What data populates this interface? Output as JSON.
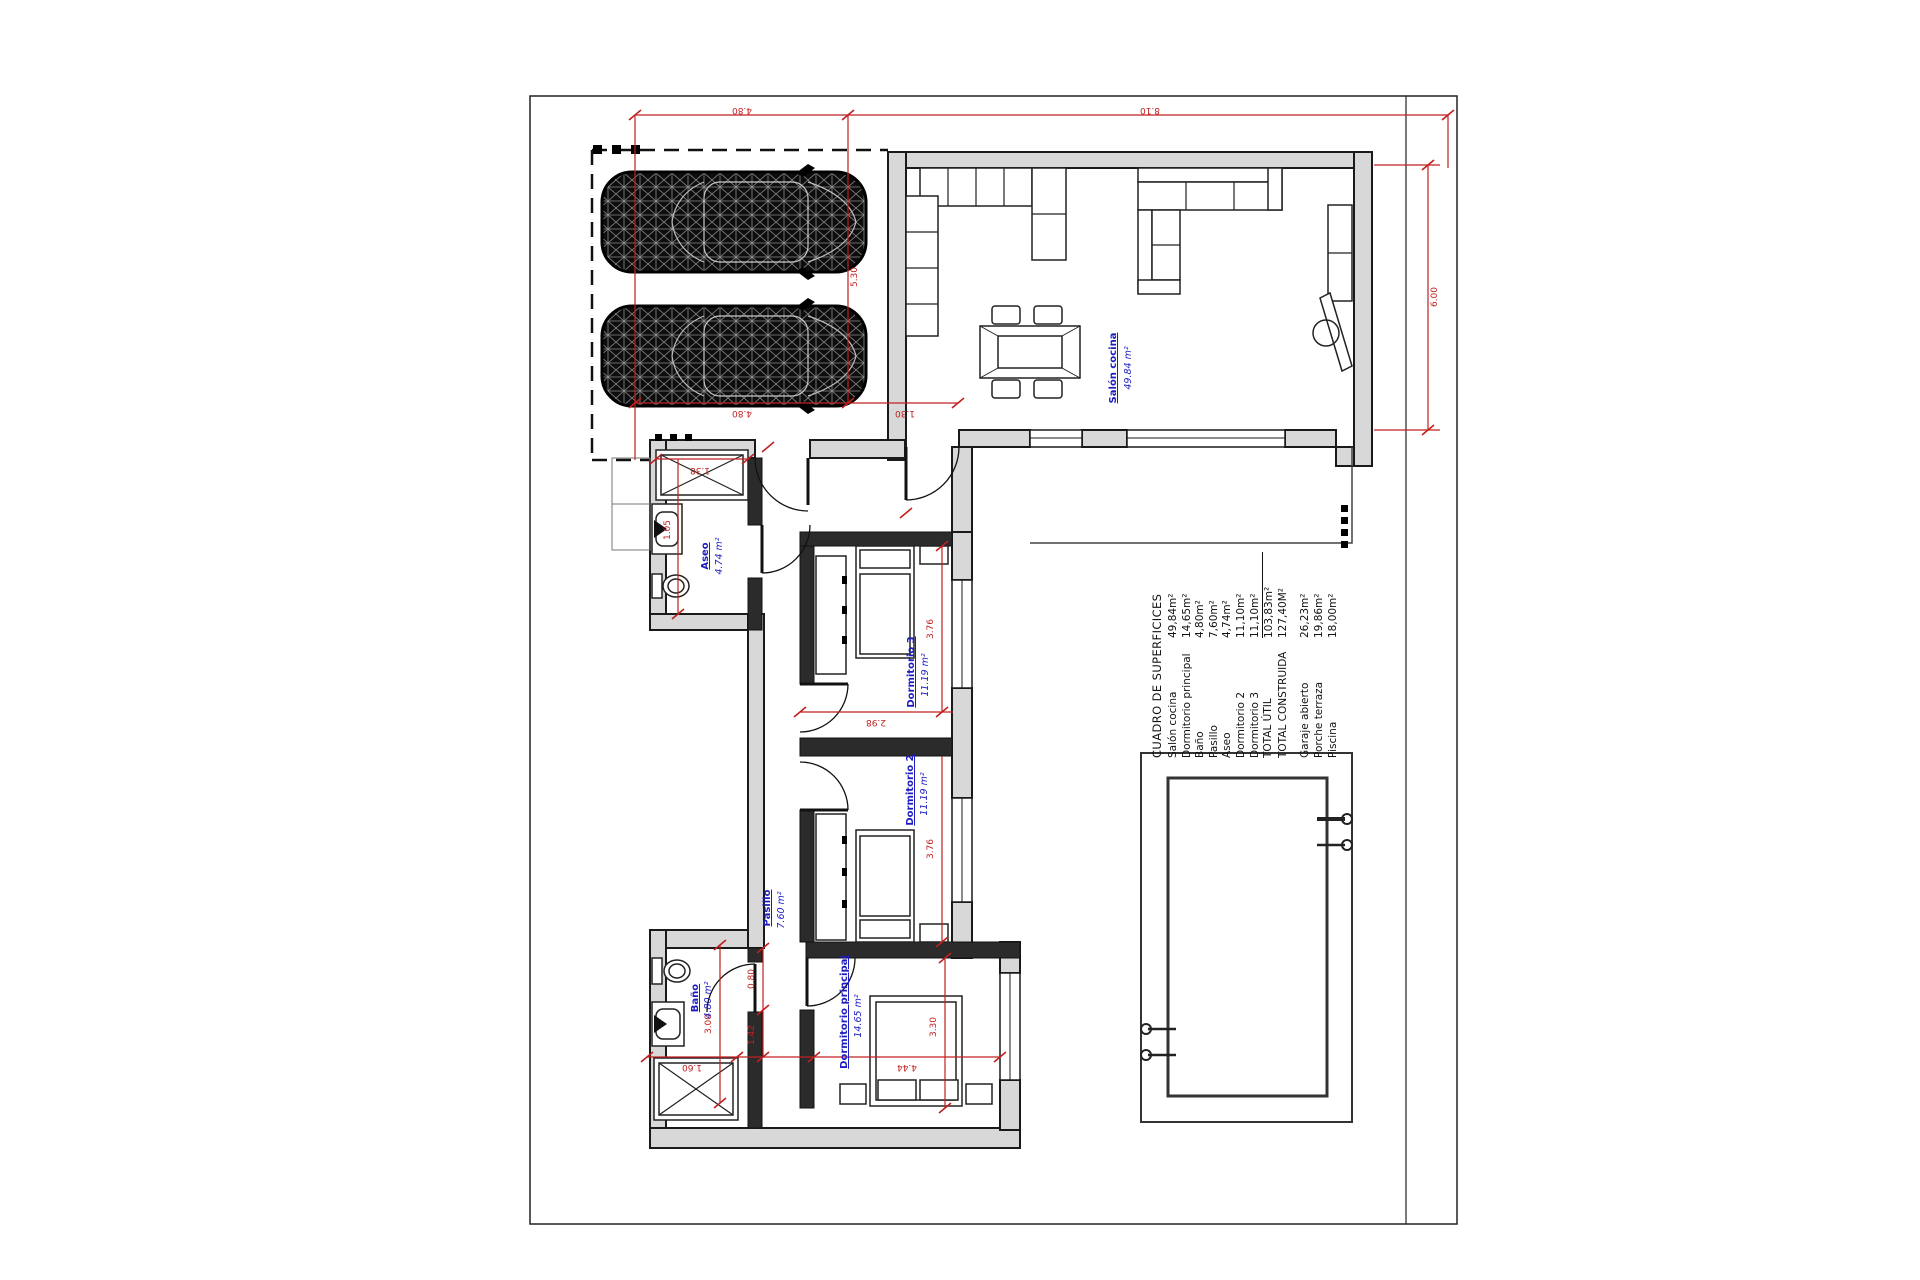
{
  "surface_table": {
    "title": "CUADRO DE SUPERFICICES",
    "rows": [
      {
        "label": "Salón cocina",
        "value": "49,84m²"
      },
      {
        "label": "Dormitorio principal",
        "value": "14,65m²"
      },
      {
        "label": "Baño",
        "value": "4,80m²"
      },
      {
        "label": "Pasillo",
        "value": "7,60m²"
      },
      {
        "label": "Aseo",
        "value": "4,74m²"
      },
      {
        "label": "Dormitorio 2",
        "value": "11,10m²"
      },
      {
        "label": "Dormitorio 3",
        "value": "11,10m²"
      },
      {
        "label": "TOTAL ÚTIL",
        "value": "103,83m²"
      },
      {
        "label": "TOTAL CONSTRUIDA",
        "value": "127,40M²"
      }
    ],
    "rows_outdoor": [
      {
        "label": "Garaje abierto",
        "value": "26,23m²"
      },
      {
        "label": "Porche terraza",
        "value": "19,86m²"
      },
      {
        "label": "Piscina",
        "value": "18,00m²"
      }
    ]
  },
  "rooms": {
    "salon": {
      "name": "Salón cocina",
      "area": "49.84 m²"
    },
    "aseo": {
      "name": "Aseo",
      "area": "4.74 m²"
    },
    "dorm3": {
      "name": "Dormitorio 3",
      "area": "11.19 m²"
    },
    "dorm2": {
      "name": "Dormitorio 2",
      "area": "11.19 m²"
    },
    "pasillo": {
      "name": "Pasillo",
      "area": "7.60 m²"
    },
    "bano": {
      "name": "Baño",
      "area": "4.80 m²"
    },
    "dormp": {
      "name": "Dormitorio principal",
      "area": "14.65 m²"
    }
  },
  "dims": {
    "garage_width": "4.80",
    "top_right": "8.10",
    "garage_depth": "5.30",
    "salon_gap": "1.30",
    "salon_depth": "6.00",
    "dorm3_depth": "3.76",
    "dorm3_width": "2.98",
    "dorm2_depth": "3.76",
    "bano_depth": "3.00",
    "bano_width": "1.60",
    "door_width": "0.80",
    "lobby_width": "1.42",
    "dormp_depth": "3.30",
    "dormp_width": "4.44",
    "aseo_width": "1.38",
    "aseo_inner": "1.05"
  },
  "colors": {
    "accent_red": "#c02020",
    "label_blue": "#1c1cc0",
    "wall_gray": "#d8d8d8"
  }
}
